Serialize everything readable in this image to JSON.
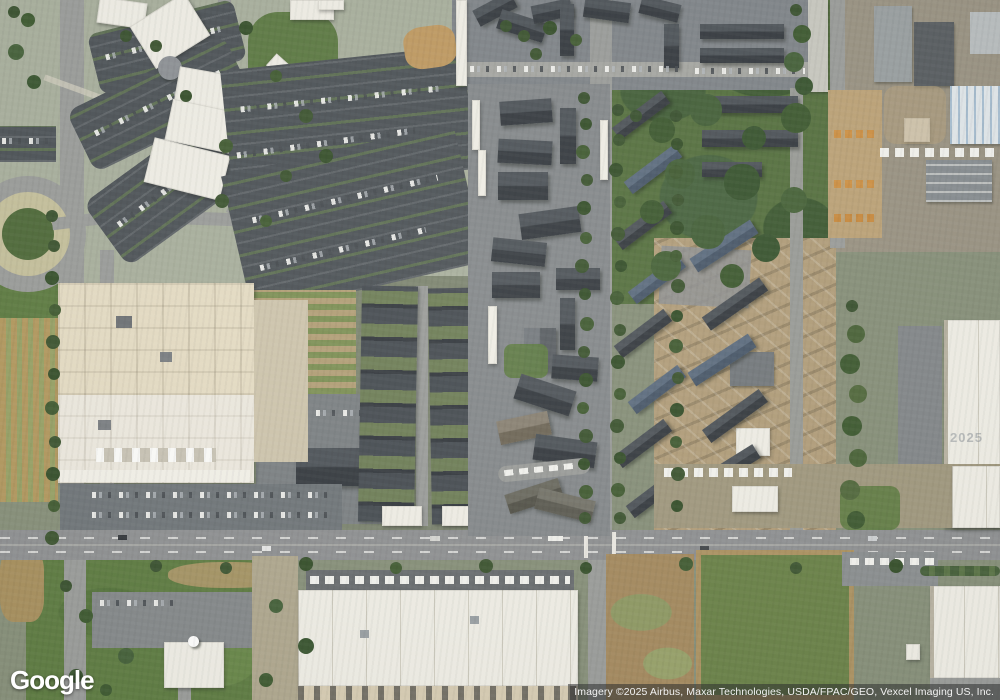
{
  "map": {
    "view_type": "satellite-imagery",
    "palette": {
      "base": "#87907a",
      "campus": "#a9b09e",
      "road": "#9b9d9b",
      "main-road": "#8f9193",
      "asphalt": "#4d5358",
      "grass": "#5e7c42",
      "field": "#567140",
      "tree": "#3a5230",
      "white-bldg": "#f1efe7",
      "cream-bldg": "#e6ddc5",
      "dark-roof": "#43484e",
      "blue-roof": "#55626f",
      "tan": "#b5a07b",
      "dirt": "#a58a5f"
    }
  },
  "branding": {
    "logo_text": "Google"
  },
  "attribution": {
    "text": "Imagery ©2025 Airbus, Maxar Technologies, USDA/FPAC/GEO, Vexcel Imaging US, Inc."
  },
  "watermark": {
    "text": "2025"
  }
}
